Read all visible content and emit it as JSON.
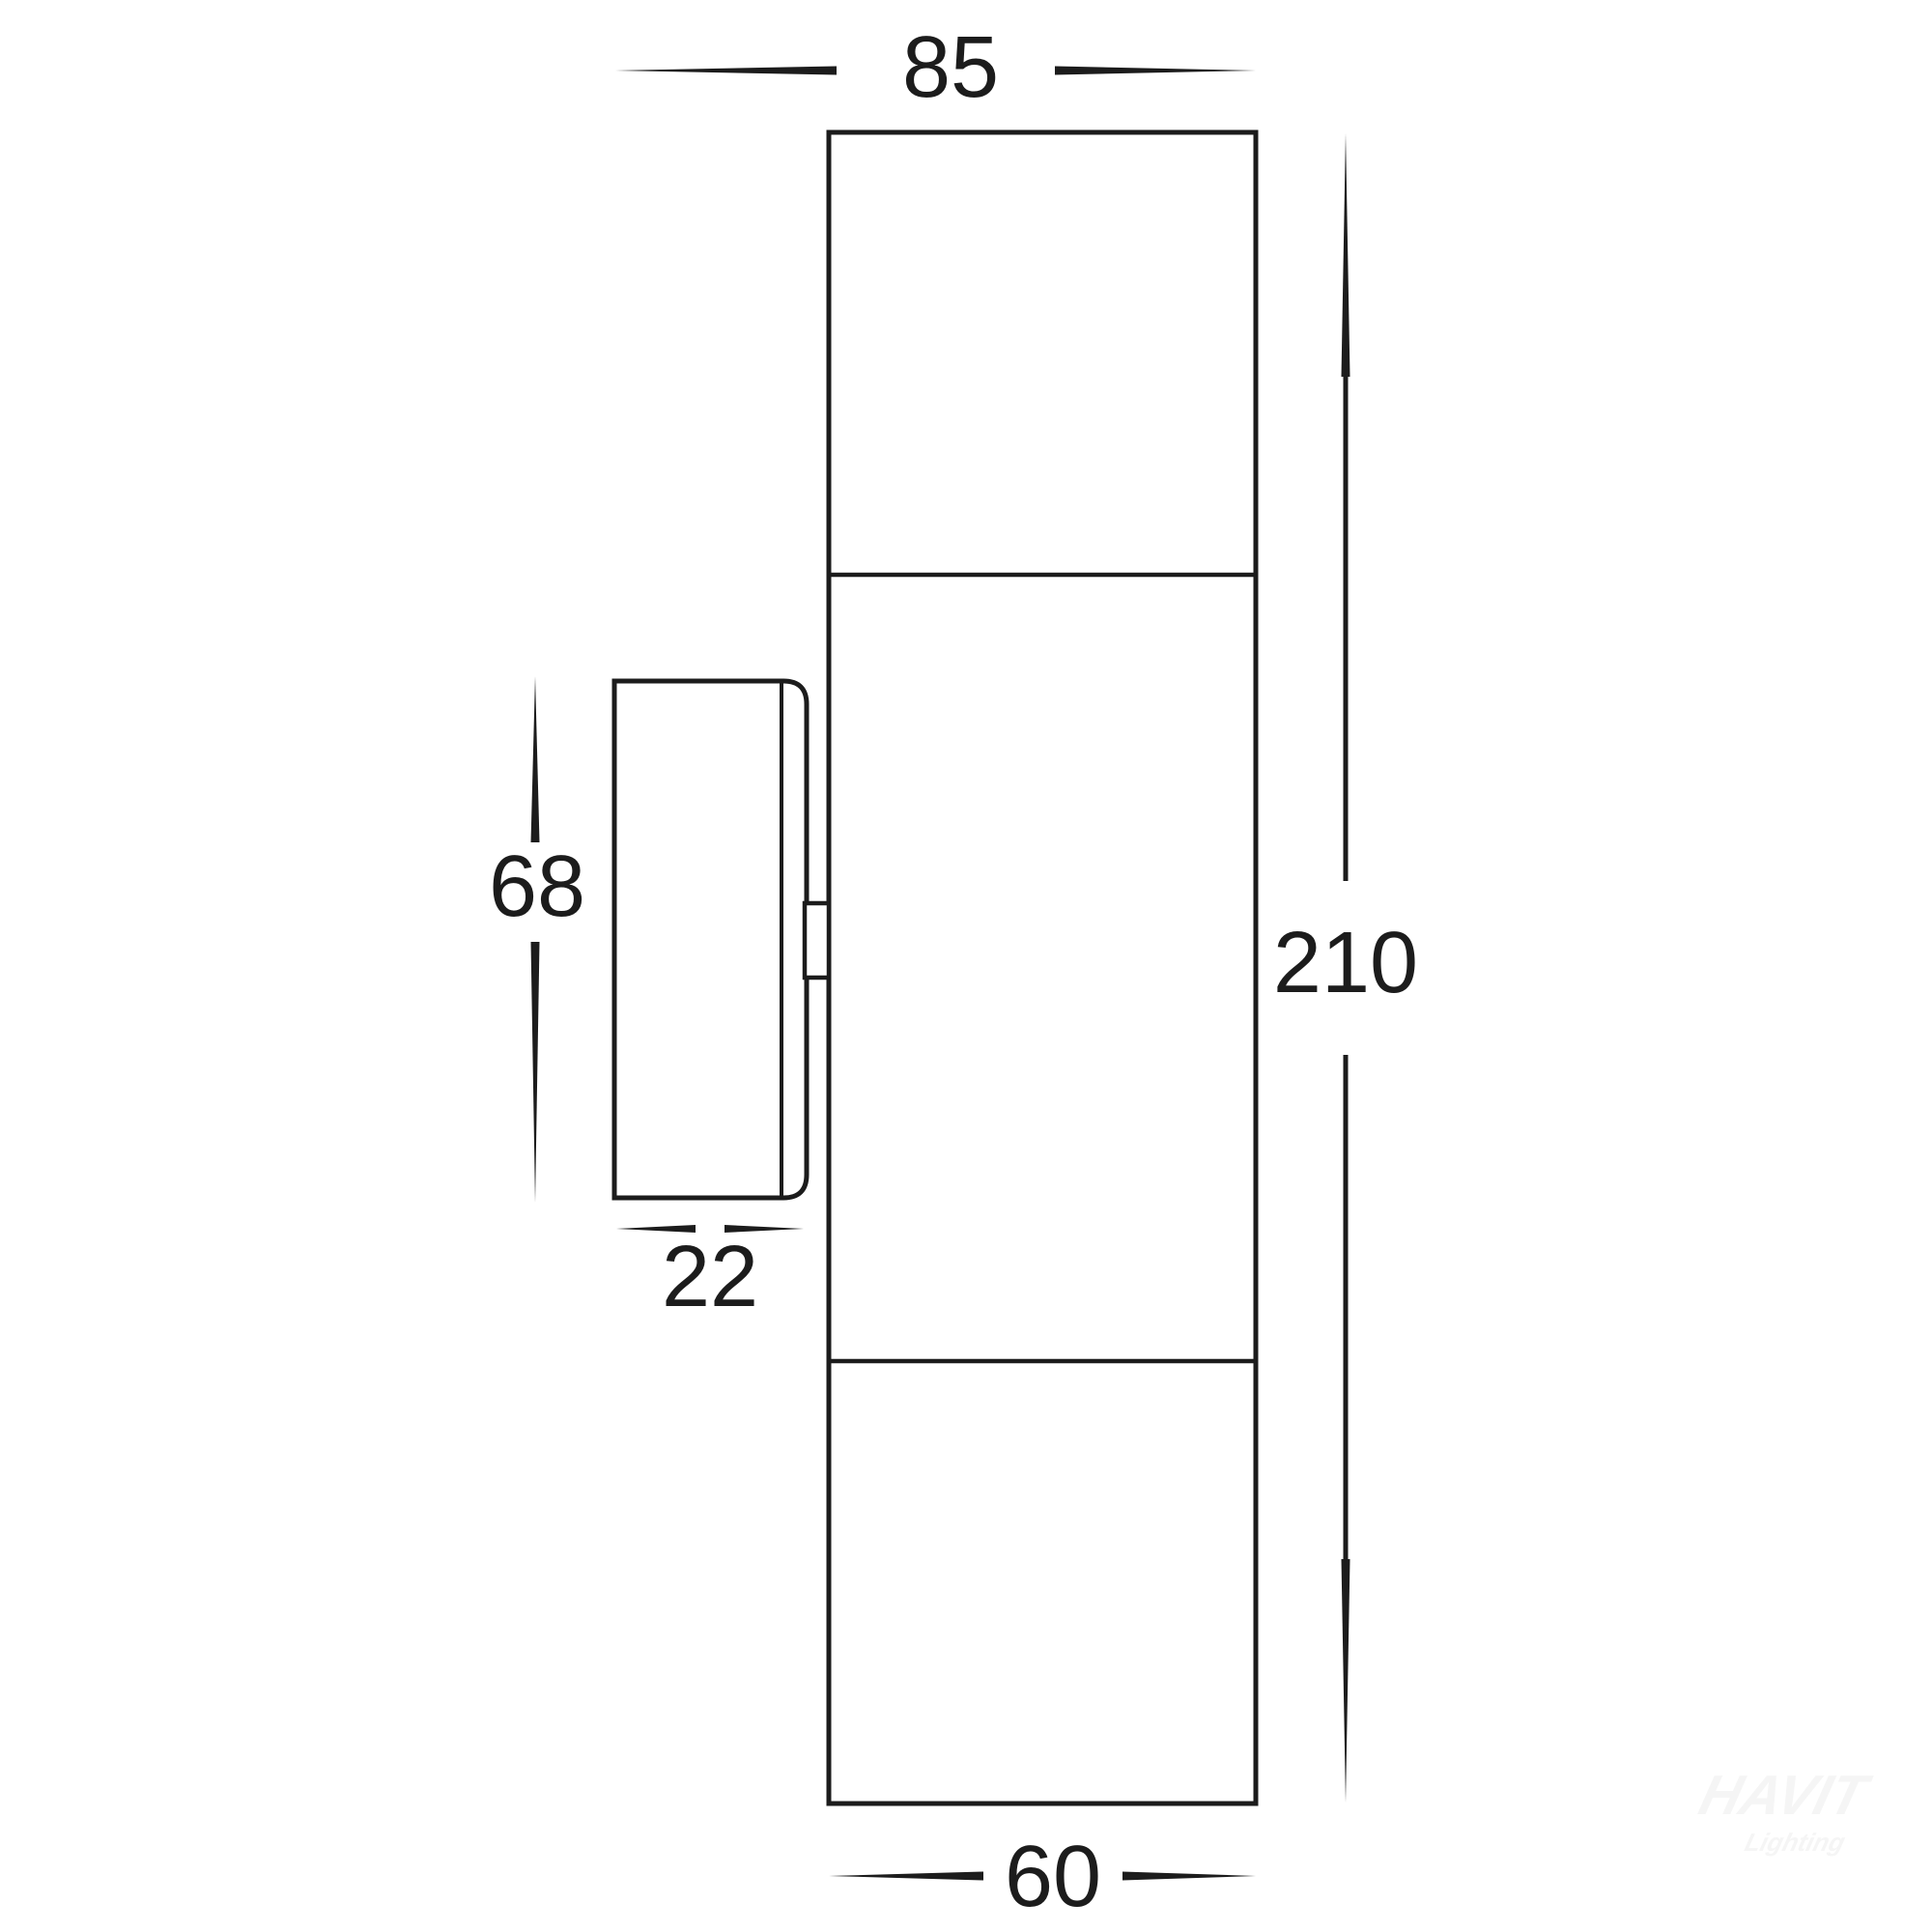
{
  "title": "Up/Down wall light technical dimension drawing (side view)",
  "dimensions": {
    "projection_width": "85",
    "overall_height": "210",
    "bracket_height": "68",
    "bracket_depth": "22",
    "body_width": "60"
  },
  "watermark": {
    "brand": "HAVIT",
    "sub": "Lighting"
  },
  "colors": {
    "line": "#1c1c1c",
    "background": "#ffffff",
    "watermark": "#f5f5f5"
  }
}
